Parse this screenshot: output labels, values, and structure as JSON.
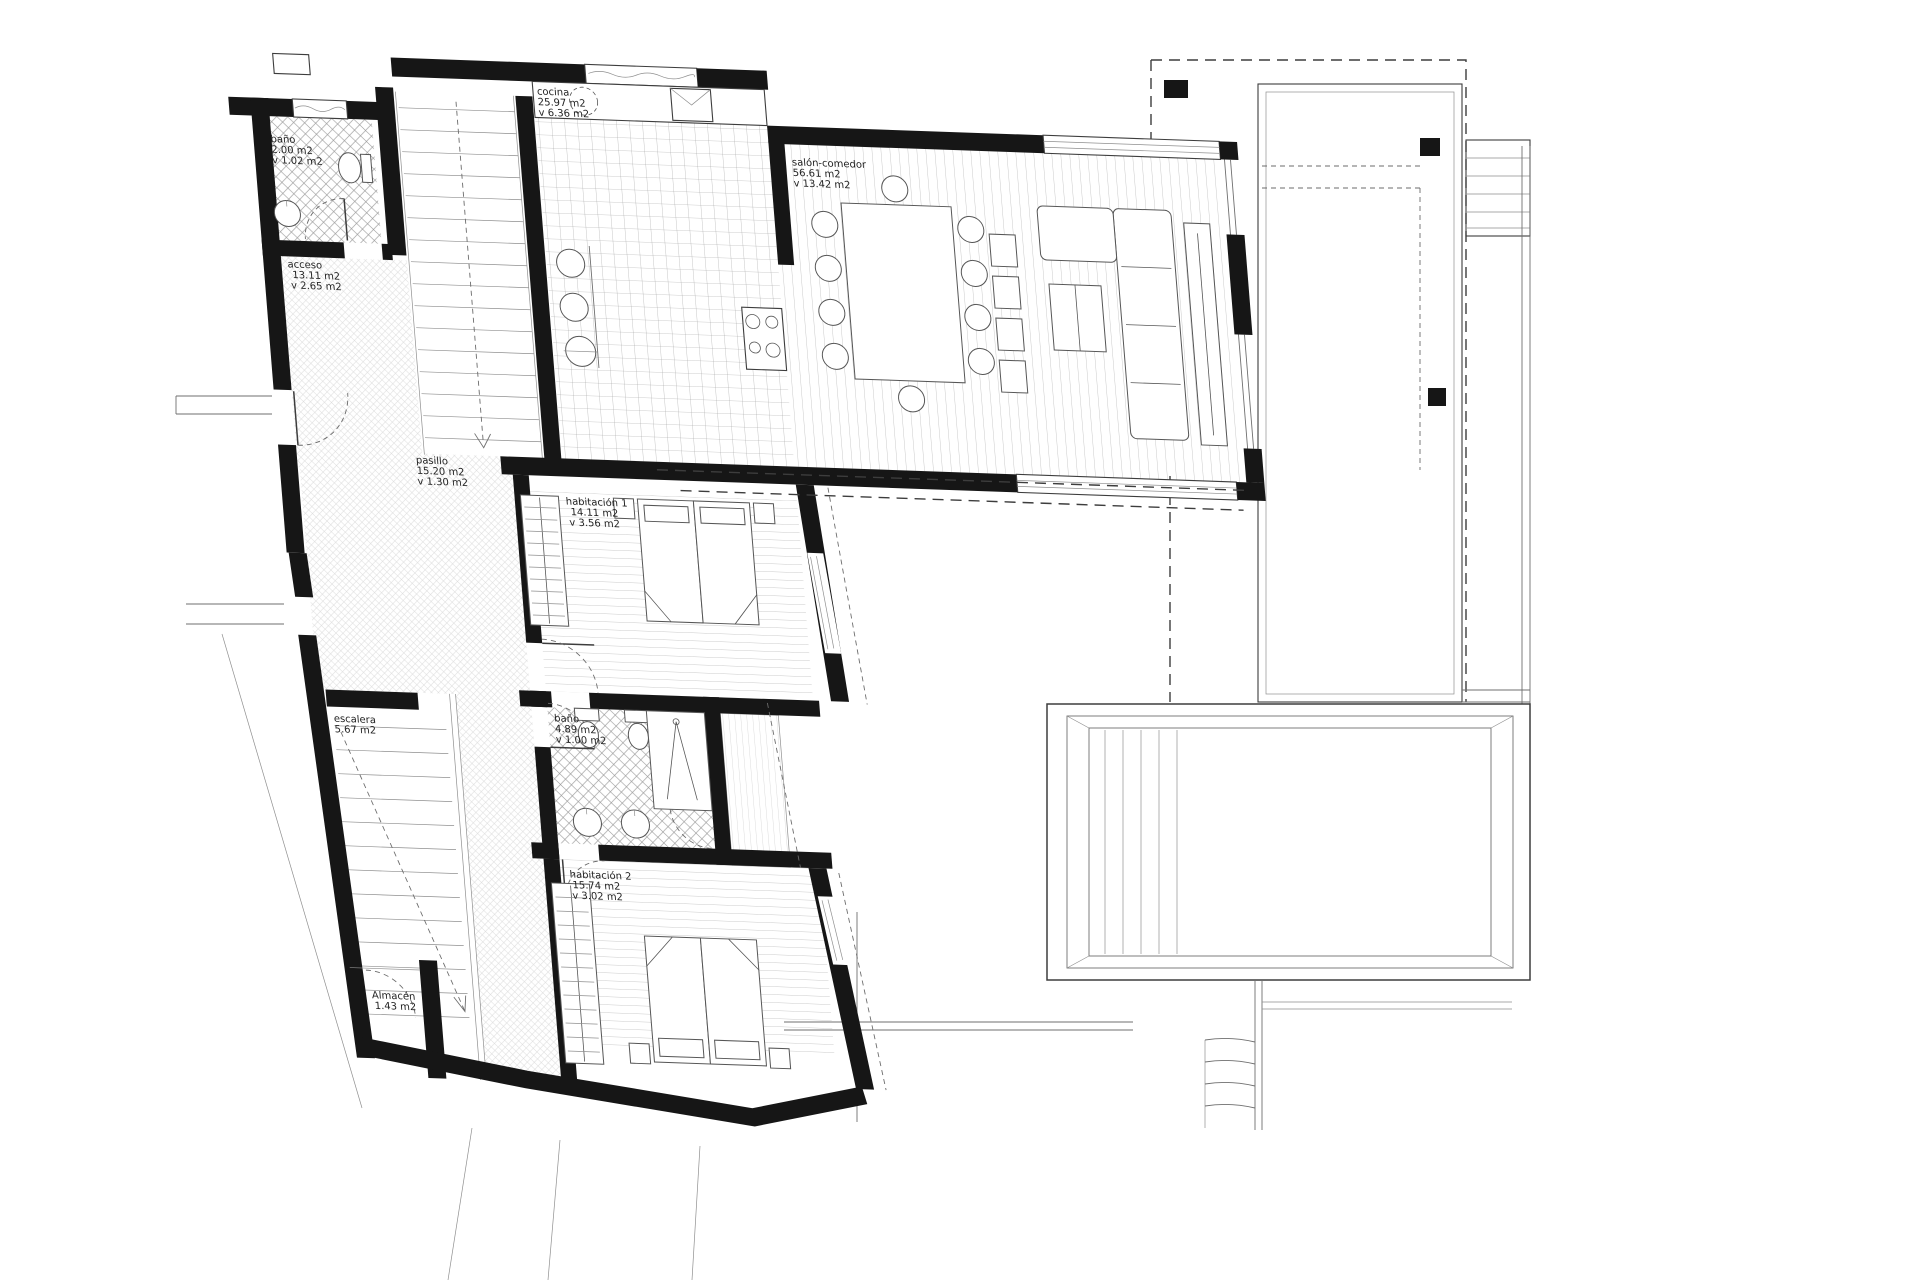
{
  "plan": {
    "drawing_type": "floor plan",
    "rooms": [
      {
        "id": "bano-1",
        "name": "baño",
        "area": "2.00 m2",
        "vent": "v 1.02 m2"
      },
      {
        "id": "acceso",
        "name": "acceso",
        "area": "13.11 m2",
        "vent": "v 2.65 m2"
      },
      {
        "id": "cocina",
        "name": "cocina",
        "area": "25.97 m2",
        "vent": "v 6.36 m2"
      },
      {
        "id": "salon-comedor",
        "name": "salón-comedor",
        "area": "56.61 m2",
        "vent": "v 13.42 m2"
      },
      {
        "id": "pasillo",
        "name": "pasillo",
        "area": "15.20 m2",
        "vent": "v 1.30 m2"
      },
      {
        "id": "habitacion-1",
        "name": "habitación 1",
        "area": "14.11 m2",
        "vent": "v 3.56 m2"
      },
      {
        "id": "escalera",
        "name": "escalera",
        "area": "5.67 m2",
        "vent": ""
      },
      {
        "id": "bano-2",
        "name": "baño",
        "area": "4.89 m2",
        "vent": "v 1.00 m2"
      },
      {
        "id": "habitacion-2",
        "name": "habitación 2",
        "area": "15.74 m2",
        "vent": "v 3.02 m2"
      },
      {
        "id": "almacen",
        "name": "Almacén",
        "area": "1.43 m2",
        "vent": ""
      }
    ]
  },
  "colors": {
    "wall": "#161616",
    "line": "#3d3d3d",
    "pattern": "#a8a8a8",
    "label": "#222222",
    "paper": "#ffffff"
  }
}
